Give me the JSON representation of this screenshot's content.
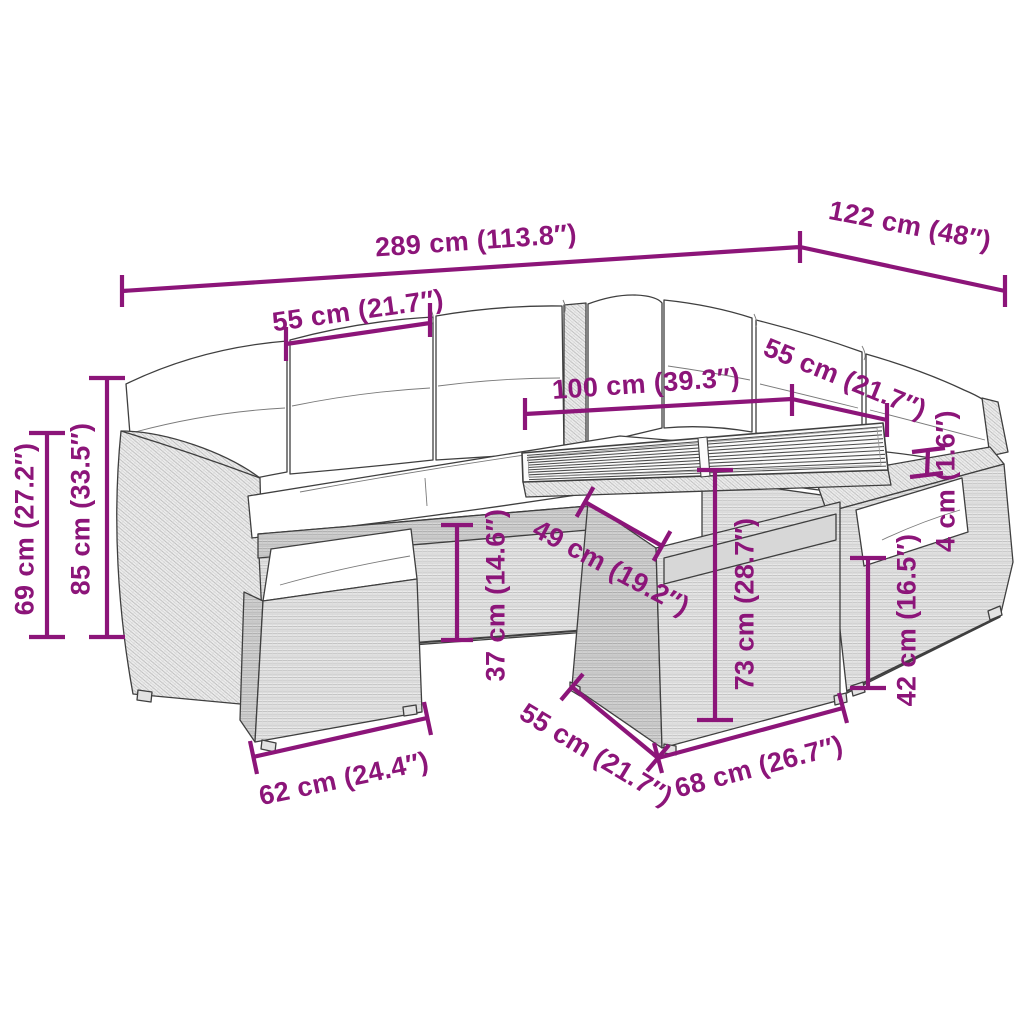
{
  "colors": {
    "accent": "#8C1579",
    "line": "#3F3F3F",
    "background": "#FFFFFF"
  },
  "dims": {
    "overall_width": "289 cm (113.8″)",
    "right_section_depth": "122 cm (48″)",
    "seat_module_width": "55 cm (21.7″)",
    "tabletop_length": "100 cm (39.3″)",
    "right_seat_module_width": "55 cm (21.7″)",
    "arm_front_height": "69 cm (27.2″)",
    "back_height": "85 cm (33.5″)",
    "base_height": "37 cm (14.6″)",
    "tabletop_depth": "49 cm (19.2″)",
    "table_height": "73 cm (28.7″)",
    "armrest_thickness": "4 cm (1.6″)",
    "seat_height": "42 cm (16.5″)",
    "footstool_width": "62 cm (24.4″)",
    "table_base_depth": "55 cm (21.7″)",
    "table_base_width": "68 cm (26.7″)"
  }
}
